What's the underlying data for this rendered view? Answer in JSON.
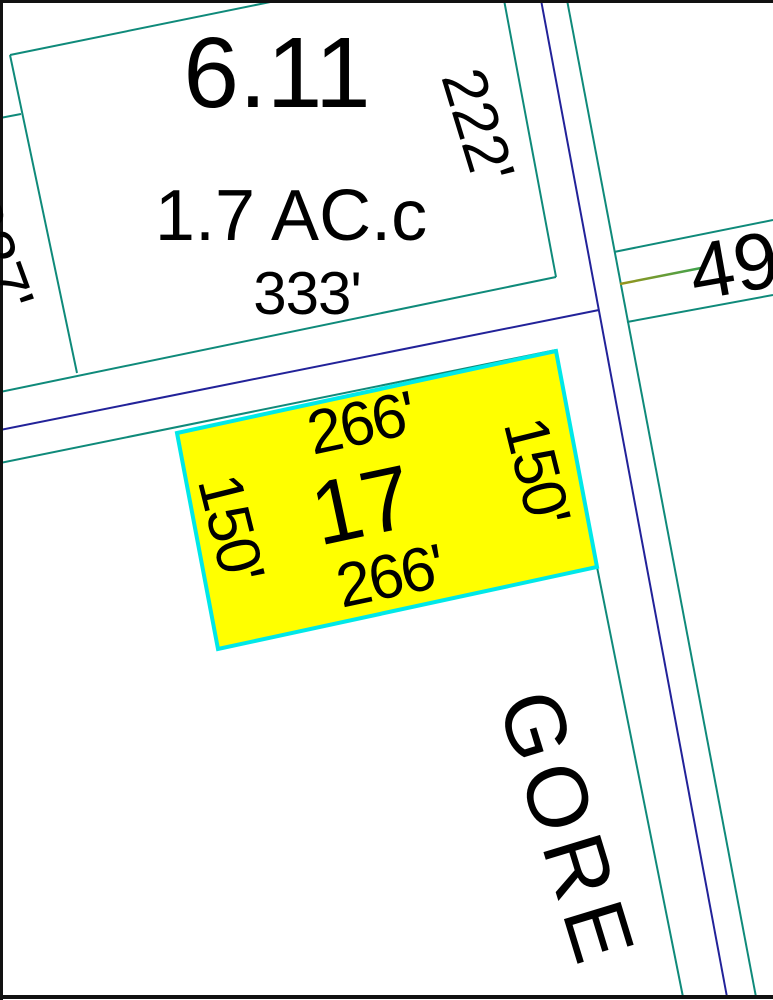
{
  "map": {
    "title": "Tax parcel map detail",
    "colors": {
      "background": "#ffffff",
      "border": "#111111",
      "parcel_line_teal": "#0f8a7a",
      "boundary_line_navy": "#222299",
      "highlight_fill": "#ffff00",
      "highlight_border": "#00e8e8",
      "route_line_start": "#97941b",
      "route_line_end": "#3fa34e",
      "text": "#000000"
    },
    "parcels": [
      {
        "id": "6.11",
        "area": "1.7 AC.c",
        "dim_bottom": "333'",
        "dim_right": "222'"
      },
      {
        "id": "17",
        "highlighted": true,
        "dim_top": "266'",
        "dim_bottom": "266'",
        "dim_left": "150'",
        "dim_right": "150'"
      }
    ],
    "left_edge_partial_dimension": "337'",
    "road_name": "GORE",
    "route_number": "49"
  }
}
